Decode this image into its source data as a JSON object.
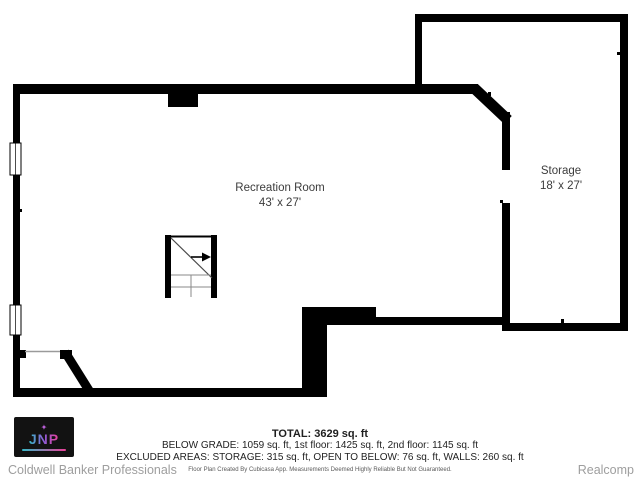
{
  "floor_plan": {
    "rooms": [
      {
        "name": "Recreation Room",
        "dimensions": "43' x 27'"
      },
      {
        "name": "Storage",
        "dimensions": "18' x 27'"
      }
    ],
    "summary": {
      "total": "TOTAL: 3629 sq. ft",
      "floors_line": "BELOW GRADE: 1059 sq. ft, 1st floor: 1425 sq. ft, 2nd floor: 1145 sq. ft",
      "excluded_line": "EXCLUDED AREAS: STORAGE: 315 sq. ft, OPEN TO BELOW: 76 sq. ft, WALLS: 260 sq. ft",
      "disclaimer": "Floor Plan Created By Cubicasa App. Measurements Deemed Highly Reliable But Not Guaranteed."
    }
  },
  "footer": {
    "logo_text": "JNP",
    "left_brand": "Coldwell Banker Professionals",
    "right_brand": "Realcomp"
  },
  "icons": {
    "logo_sparkle": "✦"
  },
  "colors": {
    "wall": "#000000",
    "room_text": "#3c3c3c",
    "summary_text": "#1f1f1f",
    "footer_text": "#9e9e9e",
    "logo_gradient_start": "#35b8c6",
    "logo_gradient_end": "#ec3f98"
  }
}
